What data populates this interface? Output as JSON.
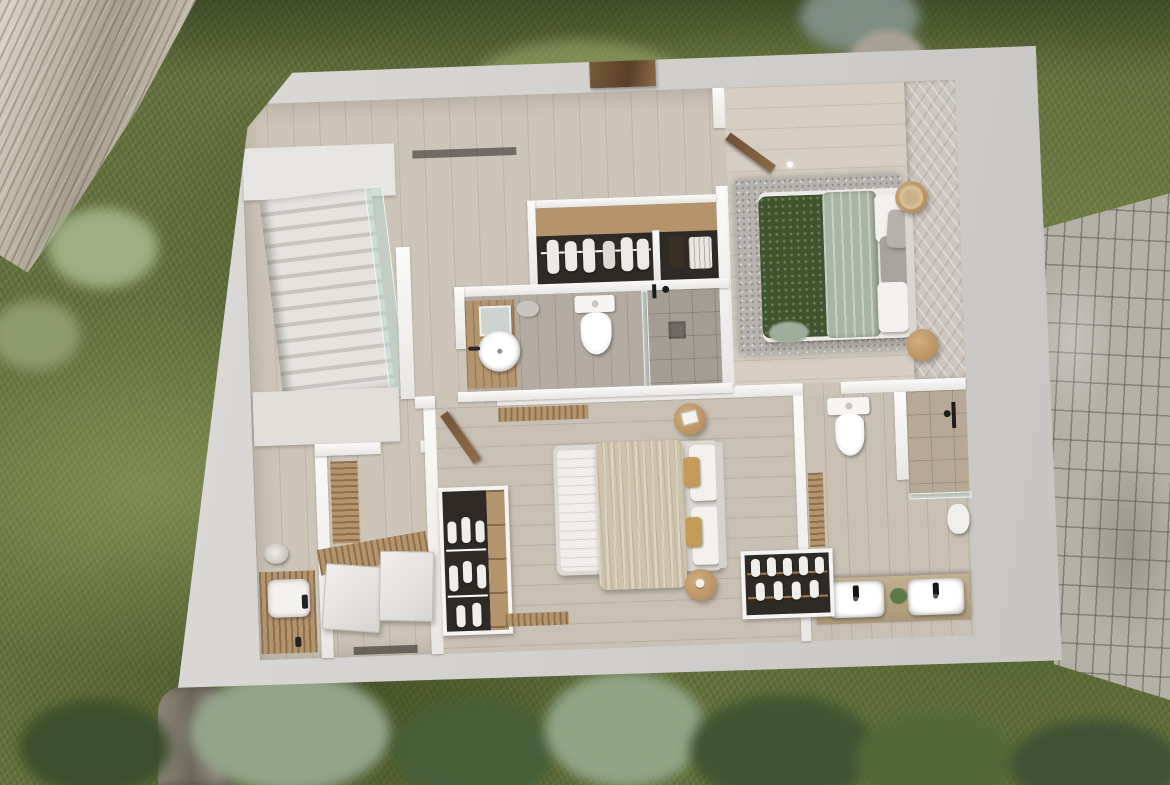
{
  "scene": {
    "kind": "3d-rendered-floor-plan",
    "view": "top-down cutaway of a house upper floor",
    "surroundings": "lawn with trees, rock outcrop at top-left, stone paver path on the right"
  },
  "rooms": [
    {
      "name": "Staircase hall",
      "features": [
        "straight staircase",
        "glass balustrade",
        "landing",
        "washbasin on wood counter"
      ]
    },
    {
      "name": "Utility room",
      "features": [
        "two white appliance units",
        "wood slat radiator",
        "slatted bench"
      ]
    },
    {
      "name": "Hallway",
      "features": [
        "wood plank flooring"
      ]
    },
    {
      "name": "Walk-in closet",
      "features": [
        "open wardrobe with hanging white clothes",
        "shelf with vase and basket"
      ]
    },
    {
      "name": "Main bedroom",
      "features": [
        "double bed with green knit throw and sage duvet",
        "grey rug",
        "two round nightstands",
        "textured accent wall",
        "open wood door"
      ]
    },
    {
      "name": "Bathroom 1",
      "features": [
        "round vessel sink on wood vanity",
        "mirror",
        "wall-hung toilet",
        "walk-in shower with drain"
      ]
    },
    {
      "name": "Bedroom 2",
      "features": [
        "double bed with beige throw",
        "open wardrobe",
        "two round nightstands",
        "wall radiator",
        "open wood door"
      ]
    },
    {
      "name": "Bathroom 2",
      "features": [
        "double vanity with two basins",
        "black taps",
        "wall-hung toilet",
        "walk-in shower",
        "towel niche with white towels",
        "plant"
      ]
    }
  ],
  "environment": {
    "ground": "grass",
    "top_left": "rock outcrop",
    "bottom": "tree canopies and trunk",
    "right": "grey brick paver path"
  },
  "palette": {
    "wall_cut": "#d2d0cd",
    "inner_wall": "#f6f5f3",
    "wood_floor": "#cdc4b8",
    "grey_wood": "#b3aba1",
    "grass": "#64713e",
    "rock": "#b0a796",
    "pavers": "#b3b0a6",
    "green_throw": "#40552f",
    "sage_duvet": "#a9b5a3",
    "beige_throw": "#cfc2aa",
    "furniture_wood": "#b3946d",
    "glass": "#b7d8cd"
  }
}
